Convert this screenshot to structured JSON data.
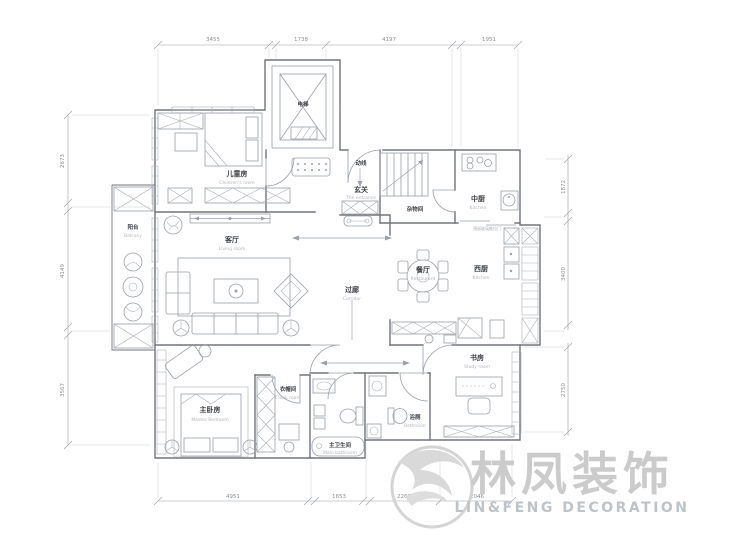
{
  "plan": {
    "rooms": {
      "elevator": {
        "zh": "电梯"
      },
      "children": {
        "zh": "儿童房",
        "en": "Children's room"
      },
      "entrance": {
        "zh": "玄关",
        "en": "The entrance"
      },
      "storage": {
        "zh": "杂物间"
      },
      "kitchen_cn": {
        "zh": "中厨",
        "en": "Kitchen"
      },
      "kitchen_west": {
        "zh": "西厨",
        "en": "Kitchen"
      },
      "dining": {
        "zh": "餐厅",
        "en": "Restaurant"
      },
      "corridor": {
        "zh": "过廊",
        "en": "Corridor"
      },
      "living": {
        "zh": "客厅",
        "en": "Living room"
      },
      "balcony": {
        "zh": "阳台",
        "en": "Balcony"
      },
      "master": {
        "zh": "主卧房",
        "en": "Master Bedroom"
      },
      "cloak": {
        "zh": "衣帽间",
        "en": "Cloak room"
      },
      "main_bath": {
        "zh": "主卫生间",
        "en": "Main bathroom"
      },
      "bath": {
        "zh": "浴厕",
        "en": "Bathroom"
      },
      "study": {
        "zh": "书房",
        "en": "Study room"
      }
    },
    "annotations": {
      "circulation": "动线",
      "sliding_door": "预留玻璃推拉门"
    },
    "dimensions": {
      "top": [
        "3455",
        "1738",
        "4197",
        "1951"
      ],
      "left": [
        "2673",
        "4149",
        "3567"
      ],
      "right": [
        "1872",
        "3400",
        "2750"
      ],
      "bottom": [
        "4951",
        "1653",
        "2269",
        "2046"
      ]
    },
    "watermark": {
      "zh": "林凤装饰",
      "en": "LIN&FENG DECORATION"
    },
    "colors": {
      "wall": "#70757c",
      "furniture": "#9aa1a8",
      "label": "#3e4247",
      "sublabel": "#b2b6ba",
      "dimension": "#8b9095",
      "watermark_zh": "#c9c9c9",
      "watermark_en": "#b9c0c7",
      "logo": "#d2d2d2"
    }
  }
}
